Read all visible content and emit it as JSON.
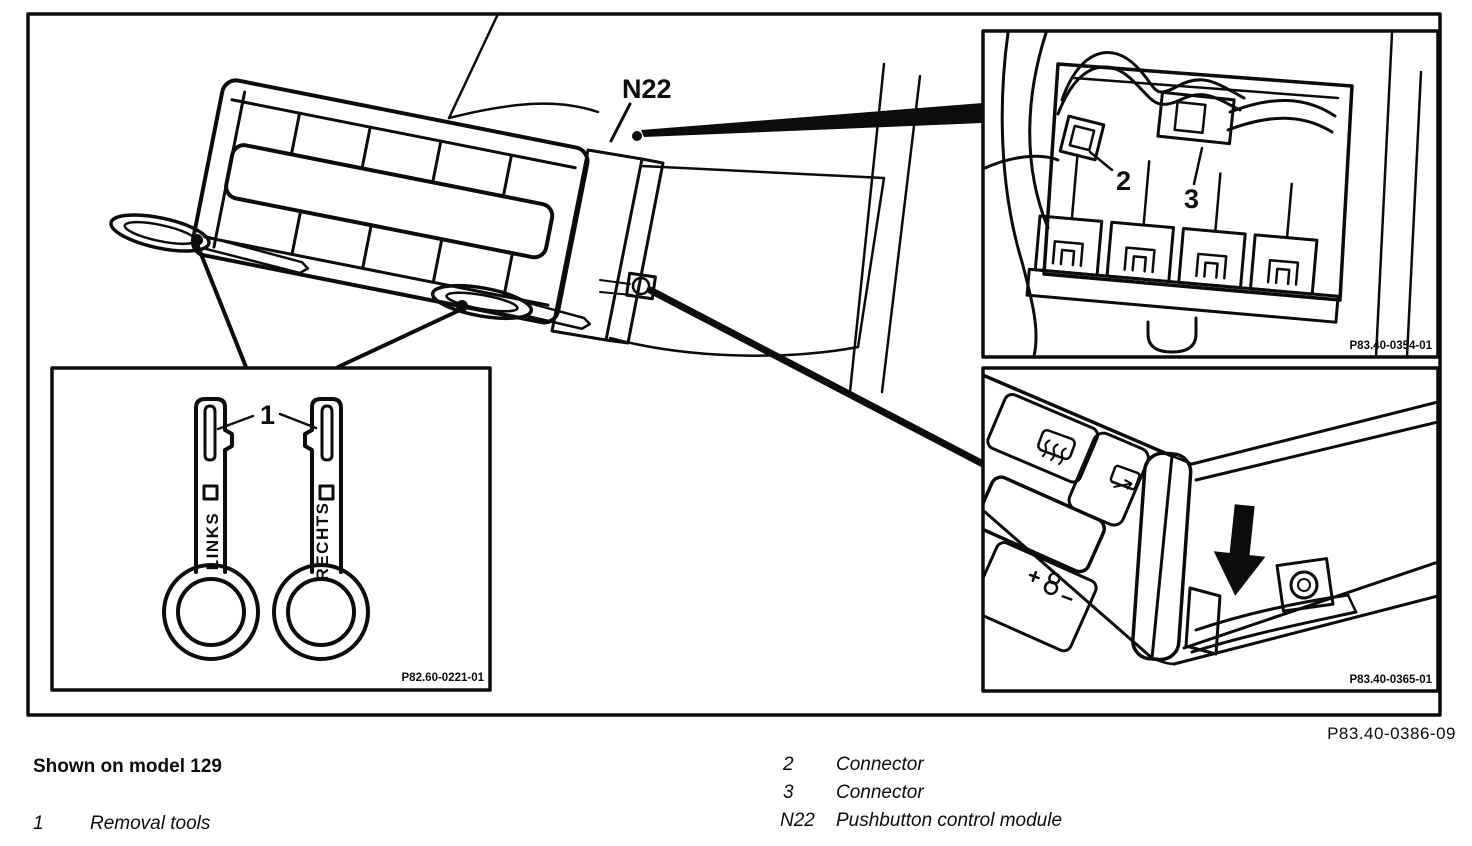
{
  "figure": {
    "number": "P83.40-0386-09",
    "note": "Shown on model 129",
    "module_label": "N22",
    "insets": {
      "tools": {
        "callout": "1",
        "left_tool_marking": "LINKS",
        "right_tool_marking": "RECHTS",
        "part_number": "P82.60-0221-01"
      },
      "connectors": {
        "callout_upper": "2",
        "callout_lower": "3",
        "part_number": "P83.40-0354-01"
      },
      "module_front": {
        "part_number": "P83.40-0365-01"
      }
    },
    "icons": {
      "defrost_button": "defrost-icon",
      "recirculation_button": "recirculation-icon",
      "temperature_button": "temperature-plus-minus-icon",
      "press_direction": "down-arrow-icon"
    }
  },
  "legend": {
    "left": [
      {
        "key": "1",
        "label": "Removal tools"
      }
    ],
    "right": [
      {
        "key": "2",
        "label": "Connector"
      },
      {
        "key": "3",
        "label": "Connector"
      },
      {
        "key": "N22",
        "label": "Pushbutton control module"
      }
    ]
  }
}
